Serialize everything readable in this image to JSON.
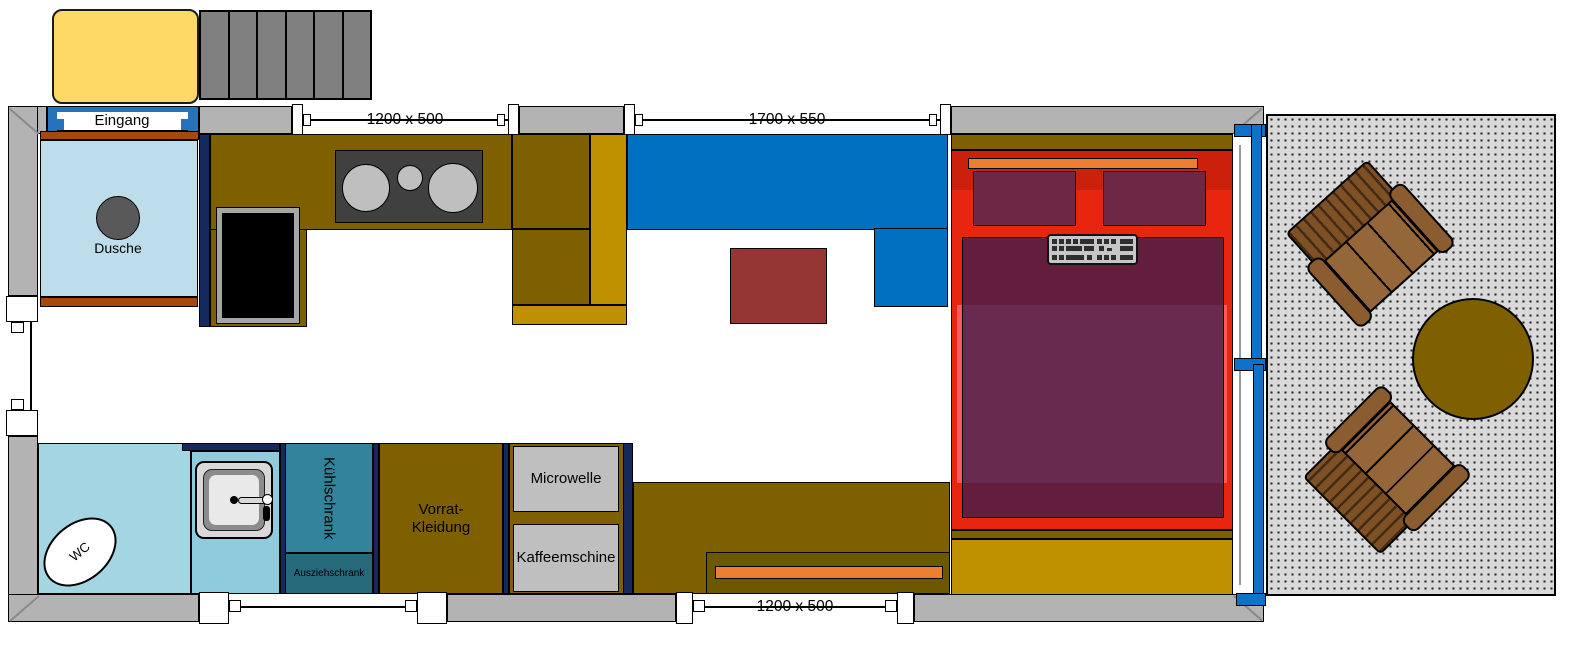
{
  "floorplan": {
    "entrance": {
      "label": "Eingang"
    },
    "rooms": {
      "shower": {
        "label": "Dusche"
      },
      "wc": {
        "label": "WC"
      },
      "fridge": {
        "label": "Kühlschrank"
      },
      "pullout_cabinet": {
        "label": "Ausziehschrank"
      },
      "storage": {
        "label_line1": "Vorrat-",
        "label_line2": "Kleidung"
      },
      "microwave": {
        "label": "Microwelle"
      },
      "coffee_machine": {
        "label": "Kaffeemschine"
      }
    },
    "windows": {
      "top_kitchen": {
        "dimension": "1200 x 500"
      },
      "top_living": {
        "dimension": "1700 x 550"
      },
      "bottom_desk": {
        "dimension": "1200 x 500"
      }
    },
    "colors": {
      "wall_gray": "#b3b3b3",
      "stairs_gray": "#808080",
      "porch_yellow": "#ffd966",
      "cabinet_olive": "#7f6000",
      "counter_gold": "#bf9000",
      "navy_trim": "#15295c",
      "sofa_blue": "#0070c0",
      "door_blue": "#0e73c8",
      "bed_red": "#e8250e",
      "mattress_salmon": "#ff5a5a",
      "blanket_purple": "rgba(62,28,74,0.78)",
      "pillow_maroon": "#6d2846",
      "accent_orange": "#ed7d31",
      "coffee_table_red": "#963634",
      "shower_blue": "#bcdde9",
      "bathroom_blue": "#a3d5e2",
      "fridge_teal": "#31849b",
      "pullout_teal": "#26697b",
      "terrace_gray": "#d9d9d9",
      "wood_brown": "#8a5c30"
    }
  }
}
